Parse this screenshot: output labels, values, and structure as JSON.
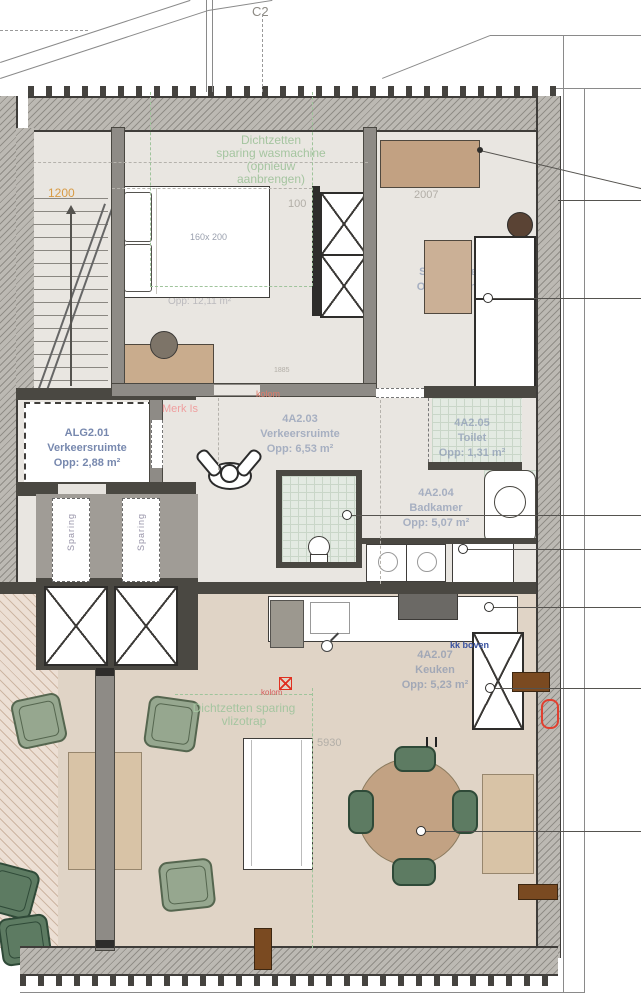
{
  "title": {
    "drawing_mark": "C2"
  },
  "rooms": [
    {
      "id": "ALG2.01",
      "name": "Verkeersruimte",
      "area": "Opp: 2,88 m²"
    },
    {
      "id": "4A2.02",
      "name": "Slaapkamer",
      "area": "Opp: 8,48 m²"
    },
    {
      "id": "4A2.03",
      "name": "Verkeersruimte",
      "area": "Opp: 6,53 m²"
    },
    {
      "id": "4A2.04",
      "name": "Badkamer",
      "area": "Opp: 5,07 m²"
    },
    {
      "id": "4A2.05",
      "name": "Toilet",
      "area": "Opp: 1,31 m²"
    },
    {
      "id": "4A2.07",
      "name": "Keuken",
      "area": "Opp: 5,23 m²"
    }
  ],
  "annotations": {
    "wasmachine_note": {
      "line1": "Dichtzetten",
      "line2": "sparing wasmachine",
      "line3": "(opnieuw",
      "line4": "aanbrengen)"
    },
    "vlizotrap_note": {
      "line1": "Dichtzetten sparing",
      "line2": "vlizotrap"
    },
    "merk": "Merk Is",
    "kolom_top": "kolom",
    "kolom_bottom": "kolom",
    "kk_boven": "kk boven",
    "sparing_left": "Sparing",
    "sparing_right": "Sparing"
  },
  "dimensions": {
    "stair_width": "1200",
    "bed_size": "160x 200",
    "dim_100": "100",
    "dim_2007": "2007",
    "dim_1885": "1885",
    "dim_5930": "5930",
    "hidden_area": "Opp: 12,11 m²"
  },
  "colors": {
    "annotation_green": "#9fc49b",
    "annotation_red": "#ee9a9a",
    "label_blue": "#7d8fb3",
    "accent_brown": "#7a4a21",
    "marker_red": "#e03020"
  }
}
